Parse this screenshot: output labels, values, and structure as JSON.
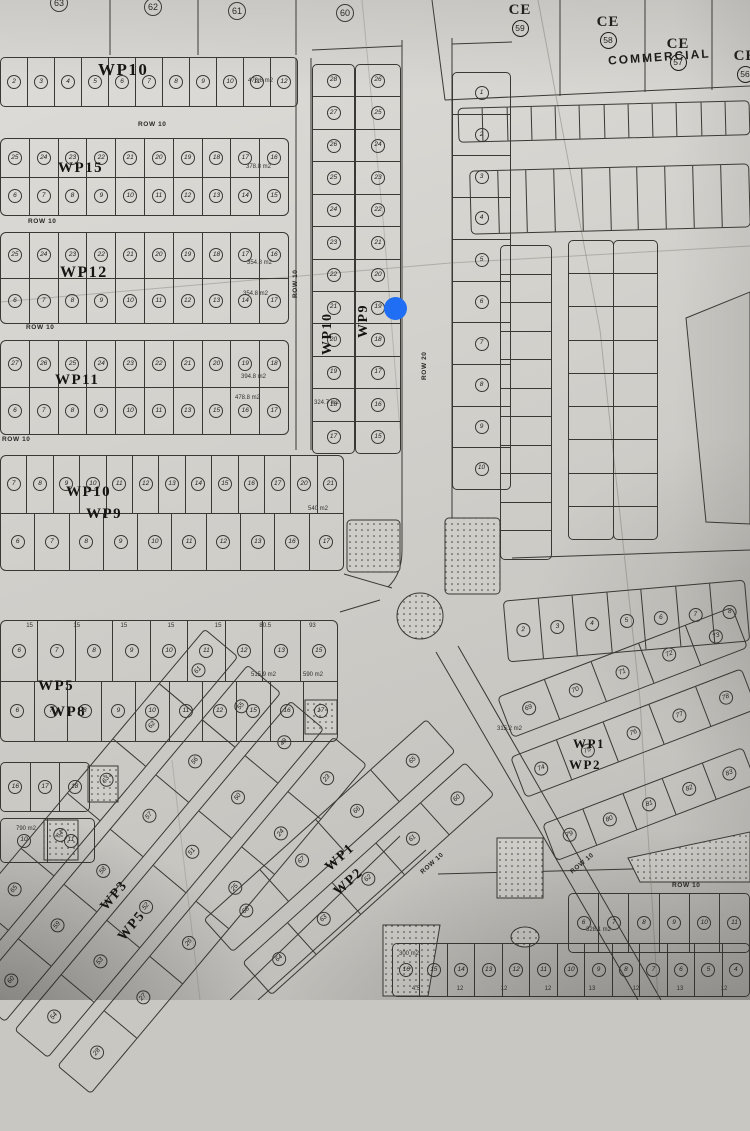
{
  "map": {
    "paper_color": "#d3d1cc",
    "line_color": "#3a3833",
    "marker_color": "#1f6ef3"
  },
  "labels": {
    "commercial": "COMMERCIAL",
    "row10": "ROW 10",
    "row20": "ROW 20",
    "top_lots": [
      "63",
      "62",
      "61",
      "60"
    ],
    "ce": [
      {
        "code": "CE",
        "num": "59"
      },
      {
        "code": "CE",
        "num": "58"
      },
      {
        "code": "CE",
        "num": "57"
      },
      {
        "code": "CE",
        "num": "56"
      }
    ],
    "wp": {
      "wp10_top": "WP10",
      "wp15": "WP15",
      "wp12": "WP12",
      "wp11": "WP11",
      "wp10_mid": "WP10",
      "wp9_mid": "WP9",
      "wp10_v": "WP10",
      "wp9_v": "WP9",
      "wp5": "WP5",
      "wp8": "WP8",
      "wp1_r": "WP1",
      "wp2_r": "WP2",
      "wp1_b": "WP1",
      "wp2_b": "WP2",
      "wp3_b": "WP3",
      "wp5_b": "WP5"
    }
  },
  "rows": {
    "wp10_top": [
      "2",
      "3",
      "4",
      "5",
      "6",
      "7",
      "8",
      "9",
      "10",
      "11",
      "12"
    ],
    "wp15_a": [
      "25",
      "24",
      "23",
      "22",
      "21",
      "20",
      "19",
      "18",
      "17",
      "16"
    ],
    "wp15_b": [
      "6",
      "7",
      "8",
      "9",
      "10",
      "11",
      "12",
      "13",
      "14",
      "15"
    ],
    "wp12_a": [
      "25",
      "24",
      "23",
      "22",
      "21",
      "20",
      "19",
      "18",
      "17",
      "16"
    ],
    "wp12_b": [
      "6",
      "7",
      "8",
      "9",
      "10",
      "11",
      "12",
      "13",
      "14",
      "17"
    ],
    "wp11_a": [
      "27",
      "26",
      "25",
      "24",
      "23",
      "22",
      "21",
      "20",
      "19",
      "18"
    ],
    "wp11_b": [
      "6",
      "7",
      "8",
      "9",
      "10",
      "11",
      "13",
      "15",
      "16",
      "17"
    ],
    "wp10_mid": [
      "7",
      "8",
      "9",
      "10",
      "11",
      "12",
      "13",
      "14",
      "15",
      "16",
      "17",
      "20",
      "21"
    ],
    "wp9_mid": [
      "6",
      "7",
      "8",
      "9",
      "10",
      "11",
      "12",
      "13",
      "16",
      "17"
    ],
    "wp5": [
      "6",
      "7",
      "8",
      "9",
      "10",
      "11",
      "12",
      "13",
      "15"
    ],
    "wp8": [
      "6",
      "7",
      "8",
      "9",
      "10",
      "11",
      "12",
      "15",
      "16",
      "17"
    ],
    "strip_a": [
      "28",
      "27",
      "26",
      "25",
      "24",
      "23",
      "22",
      "21",
      "20",
      "19",
      "18",
      "17"
    ],
    "strip_b": [
      "26",
      "25",
      "24",
      "23",
      "22",
      "21",
      "20",
      "19",
      "18",
      "17",
      "16",
      "15"
    ],
    "strip_c": [
      "1",
      "2",
      "3",
      "4",
      "5",
      "6",
      "7",
      "8",
      "9",
      "10"
    ],
    "east_row": [
      "2",
      "3",
      "4",
      "5",
      "6",
      "7",
      "8"
    ],
    "wr1": [
      "69",
      "70",
      "71",
      "72",
      "73"
    ],
    "wr2": [
      "74",
      "75",
      "76",
      "77",
      "78"
    ],
    "wr3": [
      "79",
      "80",
      "81",
      "82",
      "83"
    ],
    "br1": [
      "6",
      "7",
      "8",
      "9",
      "10",
      "11"
    ],
    "br2": [
      "16",
      "15",
      "14",
      "13",
      "12",
      "11",
      "10",
      "9",
      "8",
      "7",
      "6",
      "5",
      "4"
    ],
    "lb1": [
      "16",
      "17",
      "18"
    ],
    "lb2": [
      "10",
      "11"
    ],
    "dl1": [
      "66",
      "65",
      "64",
      "63",
      "62",
      "61"
    ],
    "dl2": [
      "60",
      "59",
      "58",
      "57",
      "56",
      "55"
    ],
    "dl3": [
      "54",
      "53",
      "52",
      "51",
      "50",
      "49"
    ],
    "dl4": [
      "28",
      "27",
      "26",
      "25",
      "24",
      "23"
    ],
    "bc1": [
      "68",
      "67",
      "66",
      "65"
    ],
    "bc2": [
      "64",
      "63",
      "62",
      "61",
      "60"
    ],
    "cs1": [
      "",
      "",
      "",
      "",
      "",
      "",
      "",
      "",
      "",
      "",
      "",
      ""
    ],
    "cs2": [
      "",
      "",
      "",
      "",
      "",
      "",
      "",
      "",
      "",
      ""
    ],
    "lad1": [
      "",
      "",
      "",
      "",
      "",
      "",
      "",
      "",
      "",
      "",
      ""
    ],
    "lad2": [
      "",
      "",
      "",
      "",
      "",
      "",
      "",
      "",
      ""
    ],
    "lad3": [
      "",
      "",
      "",
      "",
      "",
      "",
      "",
      "",
      ""
    ],
    "wp5_marks": [
      "15",
      "15",
      "15",
      "15",
      "15",
      "80.5",
      "93"
    ],
    "br2_marks": [
      "4.5",
      "12",
      "12",
      "12",
      "13",
      "12",
      "13",
      "12"
    ]
  },
  "notes": {
    "n1": "478.8 m2",
    "n2": "378.8 m2",
    "n3": "354.8 m2",
    "n4": "354.8 m2",
    "n5": "394.8 m2",
    "n6": "478.8 m2",
    "n7": "540 m2",
    "n8": "515.9 m2",
    "n9": "590 m2",
    "n10": "328.1 m2",
    "n11": "300 m2",
    "n12": "790 m2",
    "n13": "324.7 m2",
    "n14": "315.2 m2"
  }
}
